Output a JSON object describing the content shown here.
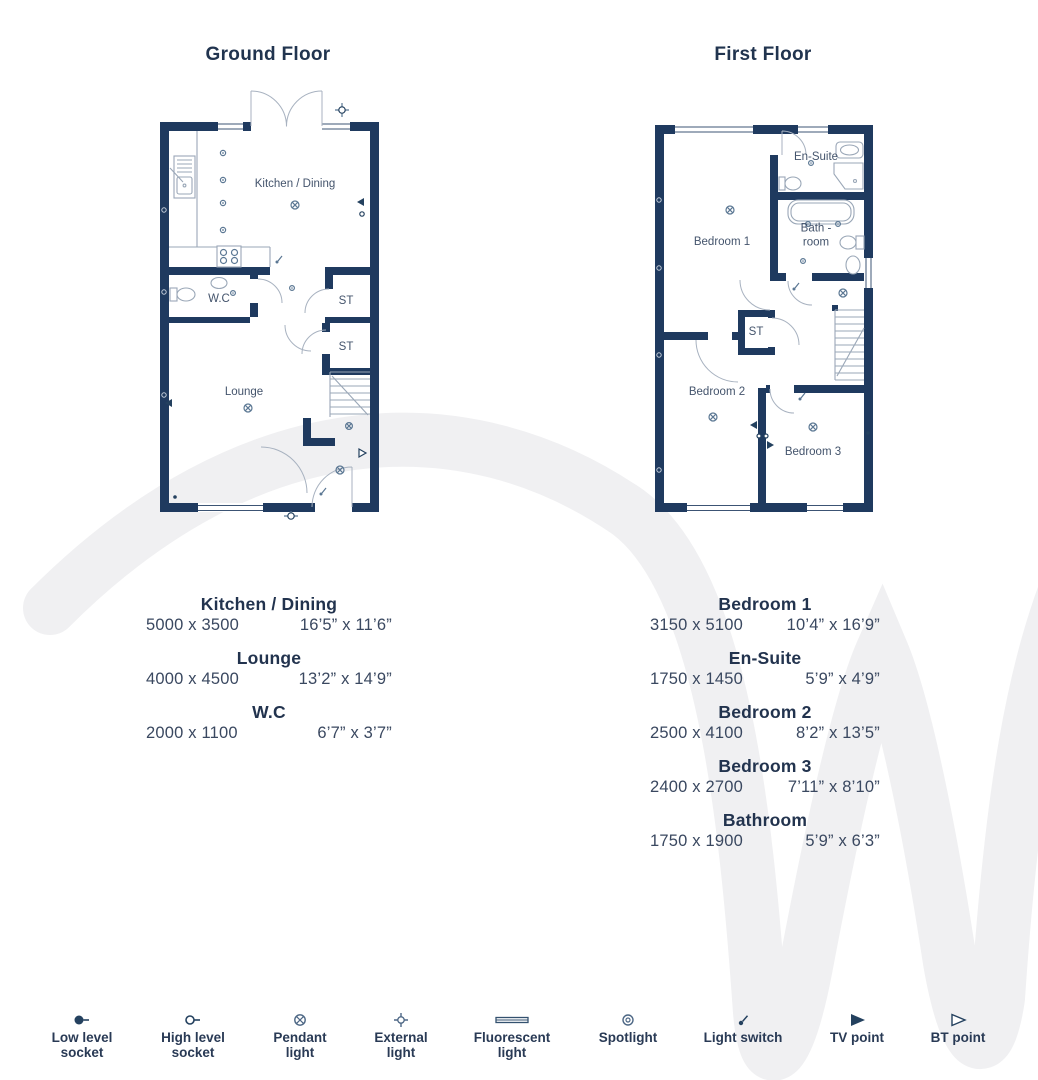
{
  "colors": {
    "wall": "#1f3a5f",
    "heading_text": "#22334e",
    "room_label_text": "#44546c",
    "fixture_line": "#9aa7b7",
    "symbol_steel": "#5b7793",
    "watermark": "#f0f0f2"
  },
  "ground_floor": {
    "title": "Ground Floor",
    "room_labels": {
      "kitchen": "Kitchen / Dining",
      "wc": "W.C",
      "st1": "ST",
      "st2": "ST",
      "lounge": "Lounge"
    },
    "dimensions": [
      {
        "name": "Kitchen / Dining",
        "metric": "5000 x 3500",
        "imperial": "16’5” x 11’6”"
      },
      {
        "name": "Lounge",
        "metric": "4000 x 4500",
        "imperial": "13’2” x 14’9”"
      },
      {
        "name": "W.C",
        "metric": "2000 x 1100",
        "imperial": "6’7” x 3’7”"
      }
    ]
  },
  "first_floor": {
    "title": "First Floor",
    "room_labels": {
      "bedroom1": "Bedroom 1",
      "ensuite": "En-Suite",
      "bathroom": "Bath -room",
      "st": "ST",
      "bedroom2": "Bedroom 2",
      "bedroom3": "Bedroom 3"
    },
    "dimensions": [
      {
        "name": "Bedroom 1",
        "metric": "3150 x 5100",
        "imperial": "10’4” x 16’9”"
      },
      {
        "name": "En-Suite",
        "metric": "1750 x 1450",
        "imperial": "5’9” x 4’9”"
      },
      {
        "name": "Bedroom 2",
        "metric": "2500 x 4100",
        "imperial": "8’2” x 13’5”"
      },
      {
        "name": "Bedroom 3",
        "metric": "2400 x 2700",
        "imperial": "7’11” x 8’10”"
      },
      {
        "name": "Bathroom",
        "metric": "1750 x 1900",
        "imperial": "5’9” x 6’3”"
      }
    ]
  },
  "legend": [
    {
      "icon": "low-level-socket-icon",
      "label": "Low level socket"
    },
    {
      "icon": "high-level-socket-icon",
      "label": "High level socket"
    },
    {
      "icon": "pendant-light-icon",
      "label": "Pendant light"
    },
    {
      "icon": "external-light-icon",
      "label": "External light"
    },
    {
      "icon": "fluorescent-light-icon",
      "label": "Fluorescent light"
    },
    {
      "icon": "spotlight-icon",
      "label": "Spotlight"
    },
    {
      "icon": "light-switch-icon",
      "label": "Light switch"
    },
    {
      "icon": "tv-point-icon",
      "label": "TV point"
    },
    {
      "icon": "bt-point-icon",
      "label": "BT point"
    }
  ]
}
